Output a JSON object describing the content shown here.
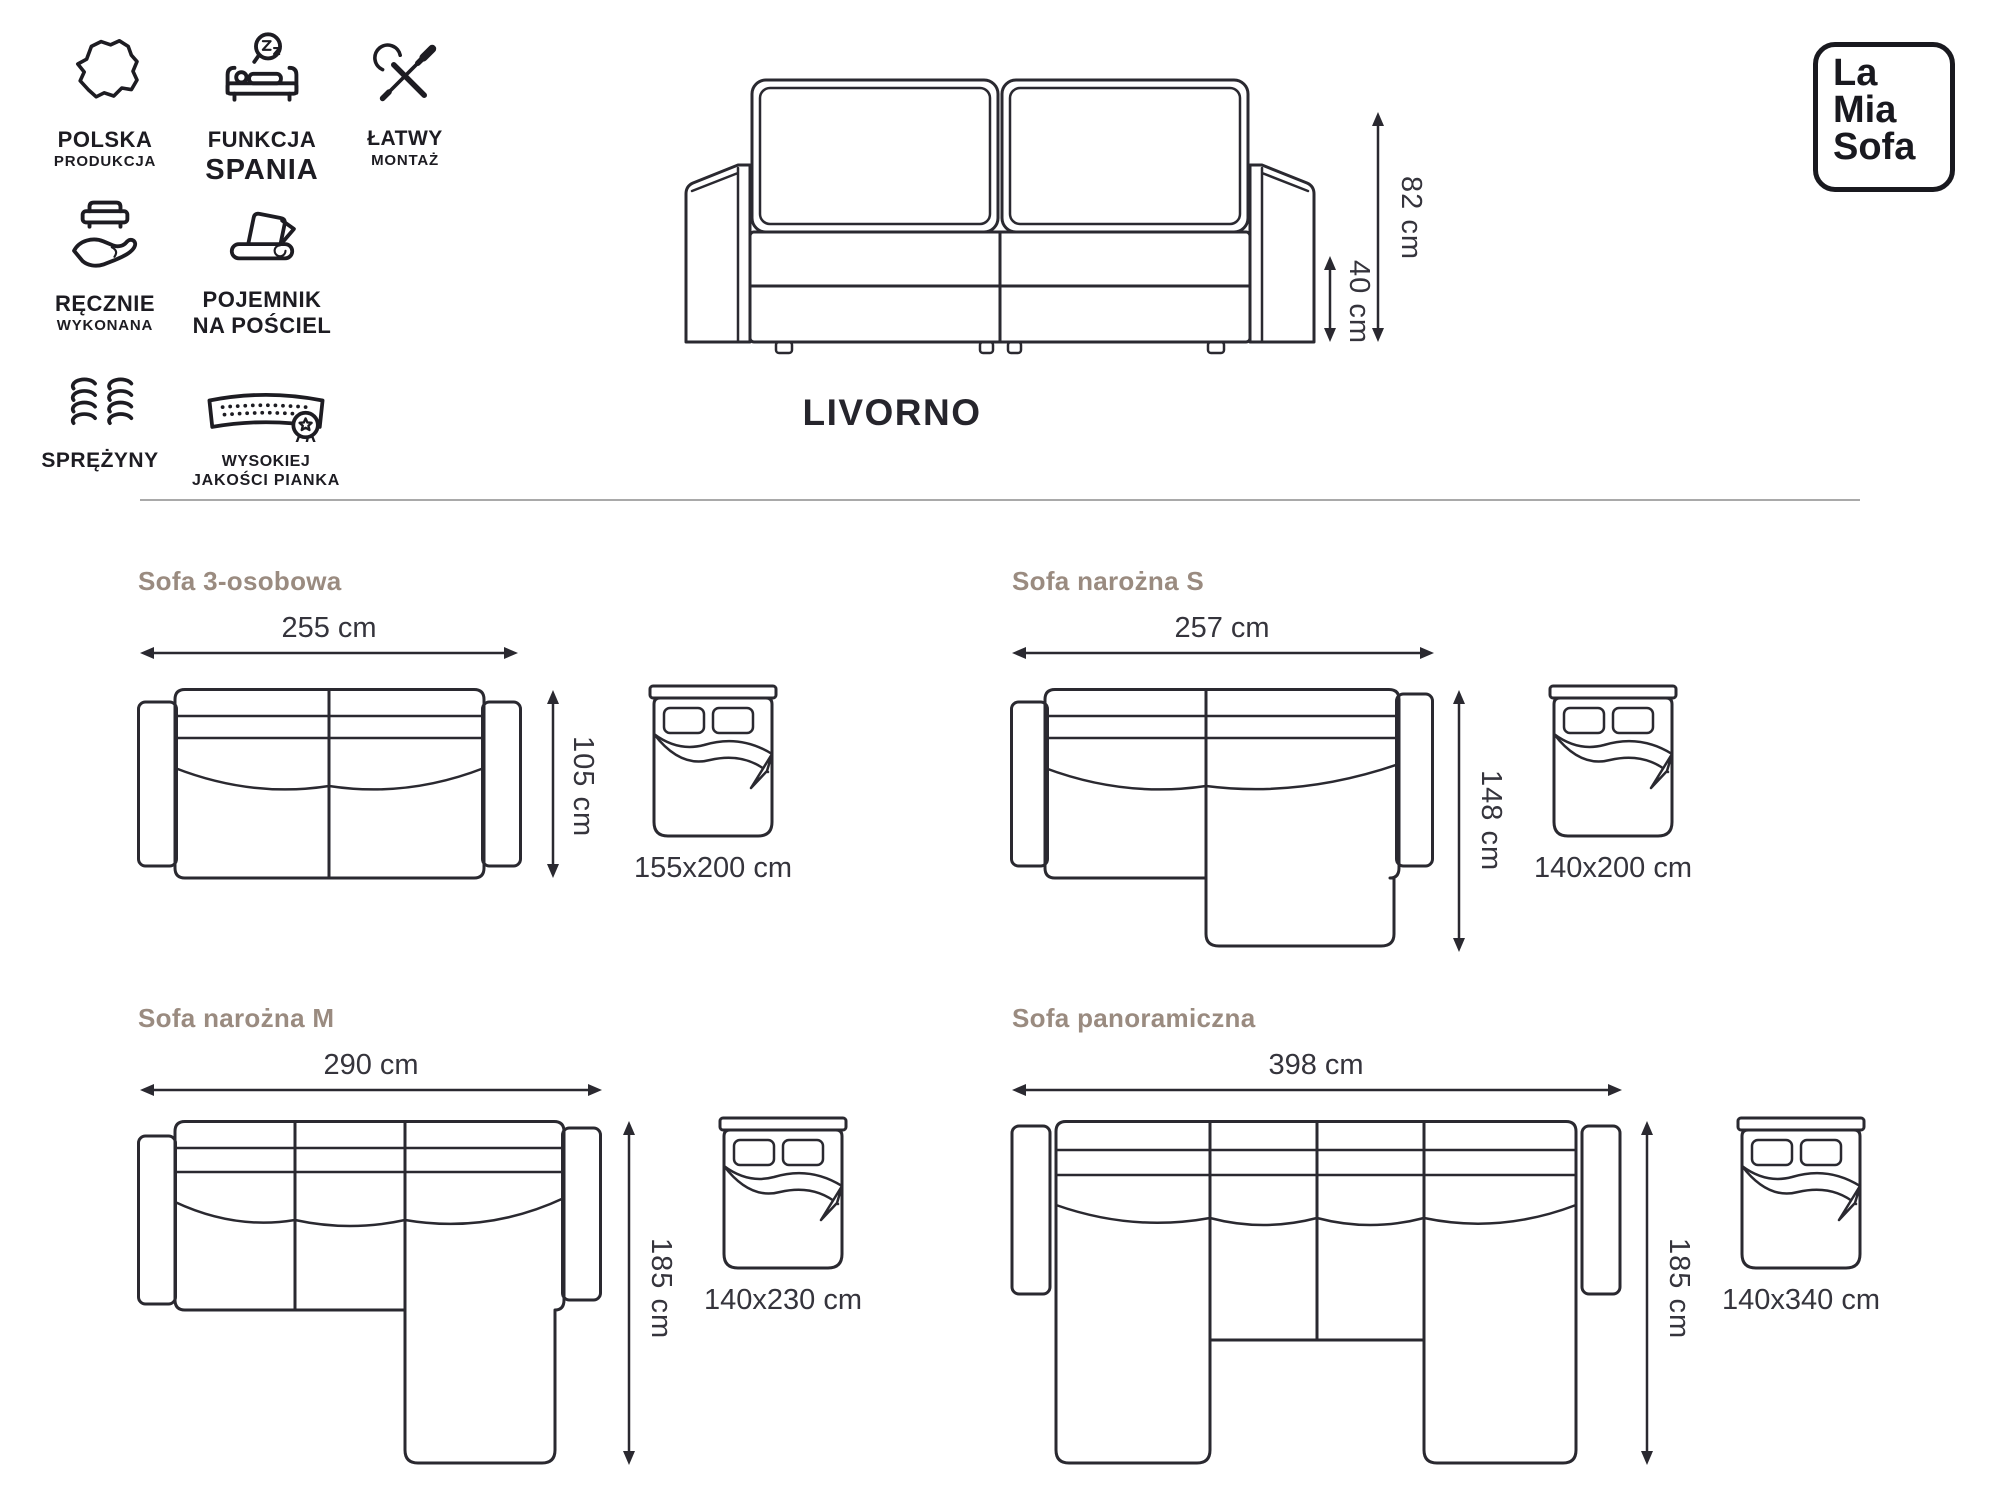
{
  "brand": {
    "line1": "La",
    "line2": "Mia",
    "line3": "Sofa"
  },
  "header": {
    "product_name": "LIVORNO",
    "total_height": "82 cm",
    "seat_height": "40 cm"
  },
  "features": [
    {
      "icon": "poland-map-icon",
      "line1": "POLSKA",
      "line2": "PRODUKCJA"
    },
    {
      "icon": "sleep-function-icon",
      "line1": "FUNKCJA",
      "line2": "SPANIA"
    },
    {
      "icon": "easy-assembly-icon",
      "line1": "ŁATWY",
      "line2": "MONTAŻ"
    },
    {
      "icon": "handmade-icon",
      "line1": "RĘCZNIE",
      "line2": "WYKONANA"
    },
    {
      "icon": "bedding-container-icon",
      "line1": "POJEMNIK",
      "line2": "NA POŚCIEL"
    },
    {
      "icon": "springs-icon",
      "line1": "SPRĘŻYNY",
      "line2": ""
    },
    {
      "icon": "foam-icon",
      "line1": "WYSOKIEJ",
      "line2": "JAKOŚCI PIANKA"
    }
  ],
  "variants": [
    {
      "name": "Sofa 3-osobowa",
      "width": "255 cm",
      "depth": "105 cm",
      "bed_size": "155x200 cm"
    },
    {
      "name": "Sofa narożna S",
      "width": "257 cm",
      "depth": "148 cm",
      "bed_size": "140x200 cm"
    },
    {
      "name": "Sofa narożna M",
      "width": "290 cm",
      "depth": "185 cm",
      "bed_size": "140x230 cm"
    },
    {
      "name": "Sofa panoramiczna",
      "width": "398 cm",
      "depth": "185 cm",
      "bed_size": "140x340 cm"
    }
  ],
  "colors": {
    "ink": "#26252c",
    "variant_title": "#9a8b80",
    "dimension_text": "#35343c",
    "divider": "#a9a9a9"
  }
}
